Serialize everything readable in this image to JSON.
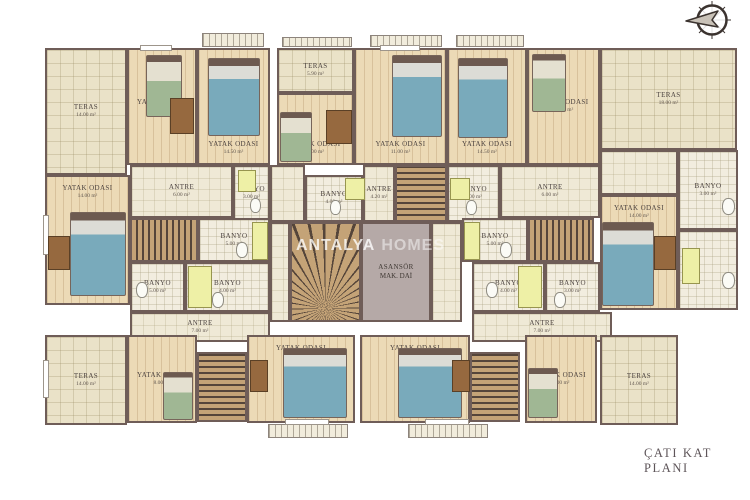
{
  "meta": {
    "title": "ÇATI KAT PLANI",
    "watermark": {
      "part1": "ANTALYA",
      "part2": "HOMES"
    },
    "compass_icon": "north-arrow"
  },
  "palette": {
    "wall": "#6f5d58",
    "wood": "#ecdab6",
    "teras": "#eae2c8",
    "tile": "#efe9d6",
    "bath": "#f2eddf",
    "elev": "#b5a9a7",
    "stairlight": "#c4a377",
    "stairdark": "#55453a",
    "fixture": "#eef0a6",
    "bedblue": "#79aabb",
    "bedgreen": "#a0b794",
    "desk": "#96693f",
    "titlecolor": "#5e5559"
  },
  "plan": {
    "rooms": [
      {
        "id": "teras-nw",
        "type": "teras",
        "label": "TERAS",
        "area": "14.00 m²",
        "rect": [
          45,
          48,
          82,
          127
        ]
      },
      {
        "id": "yatak-nw-a",
        "type": "wood",
        "label": "YATAK ODASI",
        "area": "11.60 m²",
        "rect": [
          127,
          48,
          70,
          117
        ]
      },
      {
        "id": "yatak-nw-b",
        "type": "wood",
        "label": "YATAK ODASI",
        "area": "14.50 m²",
        "rect": [
          197,
          48,
          73,
          117
        ],
        "labelPos": "bottom"
      },
      {
        "id": "teras-n",
        "type": "teras",
        "label": "TERAS",
        "area": "5.90 m²",
        "rect": [
          277,
          48,
          77,
          45
        ]
      },
      {
        "id": "yatak-n",
        "type": "wood",
        "label": "YATAK ODASI",
        "area": "5.00 m²",
        "rect": [
          277,
          93,
          77,
          72
        ],
        "labelPos": "bottom"
      },
      {
        "id": "yatak-ne-a",
        "type": "wood",
        "label": "YATAK ODASI",
        "area": "11.00 m²",
        "rect": [
          354,
          48,
          93,
          117
        ],
        "labelPos": "bottom"
      },
      {
        "id": "yatak-ne-b",
        "type": "wood",
        "label": "YATAK ODASI",
        "area": "14.50 m²",
        "rect": [
          447,
          48,
          80,
          117
        ],
        "labelPos": "bottom"
      },
      {
        "id": "yatak-ne-c",
        "type": "wood",
        "label": "YATAK ODASI",
        "area": "11.00 m²",
        "rect": [
          527,
          48,
          73,
          117
        ]
      },
      {
        "id": "teras-ne",
        "type": "teras",
        "label": "TERAS",
        "area": "18.00 m²",
        "rect": [
          600,
          48,
          137,
          102
        ]
      },
      {
        "id": "yatak-w",
        "type": "wood",
        "label": "YATAK ODASI",
        "area": "14.00 m²",
        "rect": [
          45,
          175,
          85,
          130
        ],
        "labelPos": "top"
      },
      {
        "id": "antre-nw",
        "type": "tile",
        "label": "ANTRE",
        "area": "6.00 m²",
        "rect": [
          130,
          165,
          103,
          53
        ]
      },
      {
        "id": "banyo-nw-1",
        "type": "bath",
        "label": "BANYO",
        "area": "3.00 m²",
        "rect": [
          233,
          165,
          37,
          57
        ]
      },
      {
        "id": "stairs-w",
        "type": "stairs",
        "rect": [
          130,
          218,
          68,
          44
        ]
      },
      {
        "id": "banyo-nw-2",
        "type": "bath",
        "label": "BANYO",
        "area": "5.00 m²",
        "rect": [
          198,
          218,
          72,
          44
        ]
      },
      {
        "id": "banyo-sw-1",
        "type": "bath",
        "label": "BANYO",
        "area": "5.00 m²",
        "rect": [
          130,
          262,
          55,
          50
        ]
      },
      {
        "id": "banyo-sw-2",
        "type": "bath",
        "label": "BANYO",
        "area": "4.00 m²",
        "rect": [
          185,
          262,
          85,
          50
        ]
      },
      {
        "id": "antre-sw",
        "type": "tile",
        "label": "ANTRE",
        "area": "7.00 m²",
        "rect": [
          130,
          312,
          140,
          30
        ]
      },
      {
        "id": "hall-w",
        "type": "tile",
        "rect": [
          270,
          165,
          35,
          57
        ]
      },
      {
        "id": "banyo-c-1",
        "type": "bath",
        "label": "BANYO",
        "area": "4.00 m²",
        "rect": [
          305,
          175,
          58,
          47
        ]
      },
      {
        "id": "antre-c",
        "type": "tile",
        "label": "ANTRE",
        "area": "4.20 m²",
        "rect": [
          363,
          165,
          32,
          57
        ]
      },
      {
        "id": "stairs-c",
        "type": "stairsv",
        "rect": [
          395,
          165,
          52,
          57
        ]
      },
      {
        "id": "banyo-c-2",
        "type": "bath",
        "label": "BANYO",
        "area": "3.00 m²",
        "rect": [
          447,
          165,
          53,
          57
        ]
      },
      {
        "id": "hall-c",
        "type": "tile",
        "rect": [
          270,
          222,
          20,
          100
        ]
      },
      {
        "id": "stairs-main",
        "type": "stairsfan",
        "rect": [
          290,
          222,
          71,
          100
        ]
      },
      {
        "id": "asansor",
        "type": "elev",
        "label": "ASANSÖR",
        "area": "MAK. DAİ",
        "rect": [
          361,
          222,
          70,
          100
        ]
      },
      {
        "id": "hall-e",
        "type": "tile",
        "rect": [
          431,
          222,
          31,
          100
        ]
      },
      {
        "id": "banyo-ne-1",
        "type": "bath",
        "label": "BANYO",
        "area": "5.00 m²",
        "rect": [
          462,
          218,
          66,
          44
        ]
      },
      {
        "id": "stairs-e",
        "type": "stairs",
        "rect": [
          528,
          218,
          66,
          44
        ]
      },
      {
        "id": "antre-ne",
        "type": "tile",
        "label": "ANTRE",
        "area": "6.00 m²",
        "rect": [
          500,
          165,
          100,
          53
        ]
      },
      {
        "id": "hall-ne",
        "type": "tile",
        "rect": [
          600,
          150,
          78,
          45
        ]
      },
      {
        "id": "yatak-e",
        "type": "wood",
        "label": "YATAK ODASI",
        "area": "14.00 m²",
        "rect": [
          600,
          195,
          78,
          115
        ],
        "labelPos": "top"
      },
      {
        "id": "banyo-e-1",
        "type": "bath",
        "label": "BANYO",
        "area": "3.00 m²",
        "rect": [
          678,
          150,
          60,
          80
        ]
      },
      {
        "id": "banyo-e-2",
        "type": "bath",
        "rect": [
          678,
          230,
          60,
          80
        ]
      },
      {
        "id": "banyo-se-1",
        "type": "bath",
        "label": "BANYO",
        "area": "4.00 m²",
        "rect": [
          472,
          262,
          73,
          50
        ]
      },
      {
        "id": "banyo-se-2",
        "type": "bath",
        "label": "BANYO",
        "area": "3.00 m²",
        "rect": [
          545,
          262,
          55,
          50
        ]
      },
      {
        "id": "antre-se",
        "type": "tile",
        "label": "ANTRE",
        "area": "7.00 m²",
        "rect": [
          472,
          312,
          140,
          30
        ]
      },
      {
        "id": "teras-sw",
        "type": "teras",
        "label": "TERAS",
        "area": "14.00 m²",
        "rect": [
          45,
          335,
          82,
          90
        ]
      },
      {
        "id": "yatak-sw",
        "type": "wood",
        "label": "YATAK ODASI",
        "area": "8.00 m²",
        "rect": [
          127,
          335,
          70,
          88
        ]
      },
      {
        "id": "stairs-sw",
        "type": "stairsv",
        "rect": [
          197,
          352,
          50,
          70
        ]
      },
      {
        "id": "yatak-s-a",
        "type": "wood",
        "label": "YATAK ODASI",
        "area": "19.00 m²",
        "rect": [
          247,
          335,
          108,
          88
        ],
        "labelPos": "top"
      },
      {
        "id": "yatak-s-b",
        "type": "wood",
        "label": "YATAK ODASI",
        "area": "19.00 m²",
        "rect": [
          360,
          335,
          110,
          88
        ],
        "labelPos": "top"
      },
      {
        "id": "stairs-se",
        "type": "stairsv",
        "rect": [
          470,
          352,
          50,
          70
        ]
      },
      {
        "id": "yatak-se",
        "type": "wood",
        "label": "YATAK ODASI",
        "area": "8.00 m²",
        "rect": [
          525,
          335,
          72,
          88
        ]
      },
      {
        "id": "teras-se",
        "type": "teras",
        "label": "TERAS",
        "area": "14.00 m²",
        "rect": [
          600,
          335,
          78,
          90
        ]
      }
    ],
    "furniture": [
      {
        "type": "balcony",
        "rect": [
          202,
          33,
          62,
          14
        ]
      },
      {
        "type": "balcony",
        "rect": [
          282,
          37,
          70,
          10
        ]
      },
      {
        "type": "balcony",
        "rect": [
          370,
          35,
          72,
          12
        ]
      },
      {
        "type": "balcony",
        "rect": [
          456,
          35,
          68,
          12
        ]
      },
      {
        "type": "balcony",
        "rect": [
          268,
          424,
          80,
          14
        ]
      },
      {
        "type": "balcony",
        "rect": [
          408,
          424,
          80,
          14
        ]
      },
      {
        "type": "window",
        "rect": [
          140,
          45,
          32,
          6
        ]
      },
      {
        "type": "window",
        "rect": [
          380,
          45,
          40,
          6
        ]
      },
      {
        "type": "window",
        "rect": [
          43,
          215,
          6,
          40
        ]
      },
      {
        "type": "window",
        "rect": [
          43,
          360,
          6,
          38
        ]
      },
      {
        "type": "window",
        "rect": [
          285,
          419,
          44,
          6
        ]
      },
      {
        "type": "window",
        "rect": [
          425,
          419,
          44,
          6
        ]
      },
      {
        "type": "bed-blue",
        "rect": [
          208,
          58,
          52,
          78
        ]
      },
      {
        "type": "bed-blue",
        "rect": [
          392,
          55,
          50,
          82
        ]
      },
      {
        "type": "bed-blue",
        "rect": [
          458,
          58,
          50,
          80
        ]
      },
      {
        "type": "bed-blue",
        "rect": [
          70,
          212,
          56,
          84
        ]
      },
      {
        "type": "bed-blue",
        "rect": [
          602,
          222,
          52,
          84
        ]
      },
      {
        "type": "bed-blue",
        "rect": [
          283,
          348,
          64,
          70
        ]
      },
      {
        "type": "bed-blue",
        "rect": [
          398,
          348,
          64,
          70
        ]
      },
      {
        "type": "bed-green",
        "rect": [
          146,
          55,
          36,
          62
        ]
      },
      {
        "type": "bed-green",
        "rect": [
          280,
          112,
          32,
          50
        ]
      },
      {
        "type": "bed-green",
        "rect": [
          532,
          54,
          34,
          58
        ]
      },
      {
        "type": "bed-green",
        "rect": [
          163,
          372,
          30,
          48
        ]
      },
      {
        "type": "bed-green",
        "rect": [
          528,
          368,
          30,
          50
        ]
      },
      {
        "type": "desk",
        "rect": [
          170,
          98,
          24,
          36
        ]
      },
      {
        "type": "desk",
        "rect": [
          326,
          110,
          26,
          34
        ]
      },
      {
        "type": "desk",
        "rect": [
          48,
          236,
          22,
          34
        ]
      },
      {
        "type": "desk",
        "rect": [
          654,
          236,
          22,
          34
        ]
      },
      {
        "type": "desk",
        "rect": [
          250,
          360,
          18,
          32
        ]
      },
      {
        "type": "desk",
        "rect": [
          452,
          360,
          18,
          32
        ]
      },
      {
        "type": "shower",
        "rect": [
          252,
          222,
          16,
          38
        ]
      },
      {
        "type": "shower",
        "rect": [
          188,
          266,
          24,
          42
        ]
      },
      {
        "type": "shower",
        "rect": [
          464,
          222,
          16,
          38
        ]
      },
      {
        "type": "shower",
        "rect": [
          518,
          266,
          24,
          42
        ]
      },
      {
        "type": "shower",
        "rect": [
          345,
          178,
          20,
          22
        ]
      },
      {
        "type": "shower",
        "rect": [
          450,
          178,
          20,
          22
        ]
      },
      {
        "type": "shower",
        "rect": [
          682,
          248,
          18,
          36
        ]
      },
      {
        "type": "shower",
        "rect": [
          238,
          170,
          18,
          22
        ]
      },
      {
        "type": "toilet",
        "rect": [
          136,
          282,
          12,
          16
        ]
      },
      {
        "type": "toilet",
        "rect": [
          212,
          292,
          12,
          16
        ]
      },
      {
        "type": "toilet",
        "rect": [
          236,
          242,
          12,
          16
        ]
      },
      {
        "type": "toilet",
        "rect": [
          250,
          198,
          11,
          15
        ]
      },
      {
        "type": "toilet",
        "rect": [
          330,
          200,
          11,
          15
        ]
      },
      {
        "type": "toilet",
        "rect": [
          466,
          200,
          11,
          15
        ]
      },
      {
        "type": "toilet",
        "rect": [
          500,
          242,
          12,
          16
        ]
      },
      {
        "type": "toilet",
        "rect": [
          554,
          292,
          12,
          16
        ]
      },
      {
        "type": "toilet",
        "rect": [
          486,
          282,
          12,
          16
        ]
      },
      {
        "type": "toilet",
        "rect": [
          722,
          198,
          13,
          17
        ]
      },
      {
        "type": "toilet",
        "rect": [
          722,
          272,
          13,
          17
        ]
      }
    ]
  }
}
